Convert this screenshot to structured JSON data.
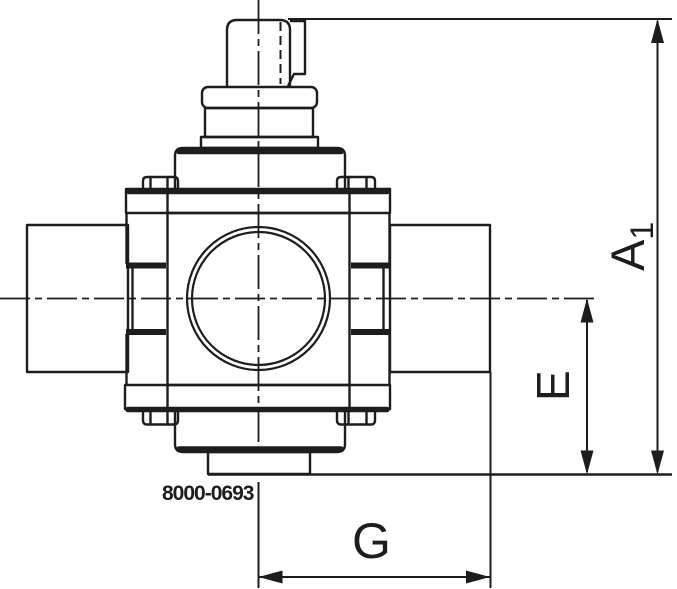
{
  "drawing": {
    "part_number": "8000-0693",
    "dimensions": {
      "a1": {
        "label": "A",
        "subscript": "1"
      },
      "e": {
        "label": "E"
      },
      "g": {
        "label": "G"
      }
    },
    "colors": {
      "line": "#1d1d1b",
      "background": "#ffffff"
    }
  }
}
